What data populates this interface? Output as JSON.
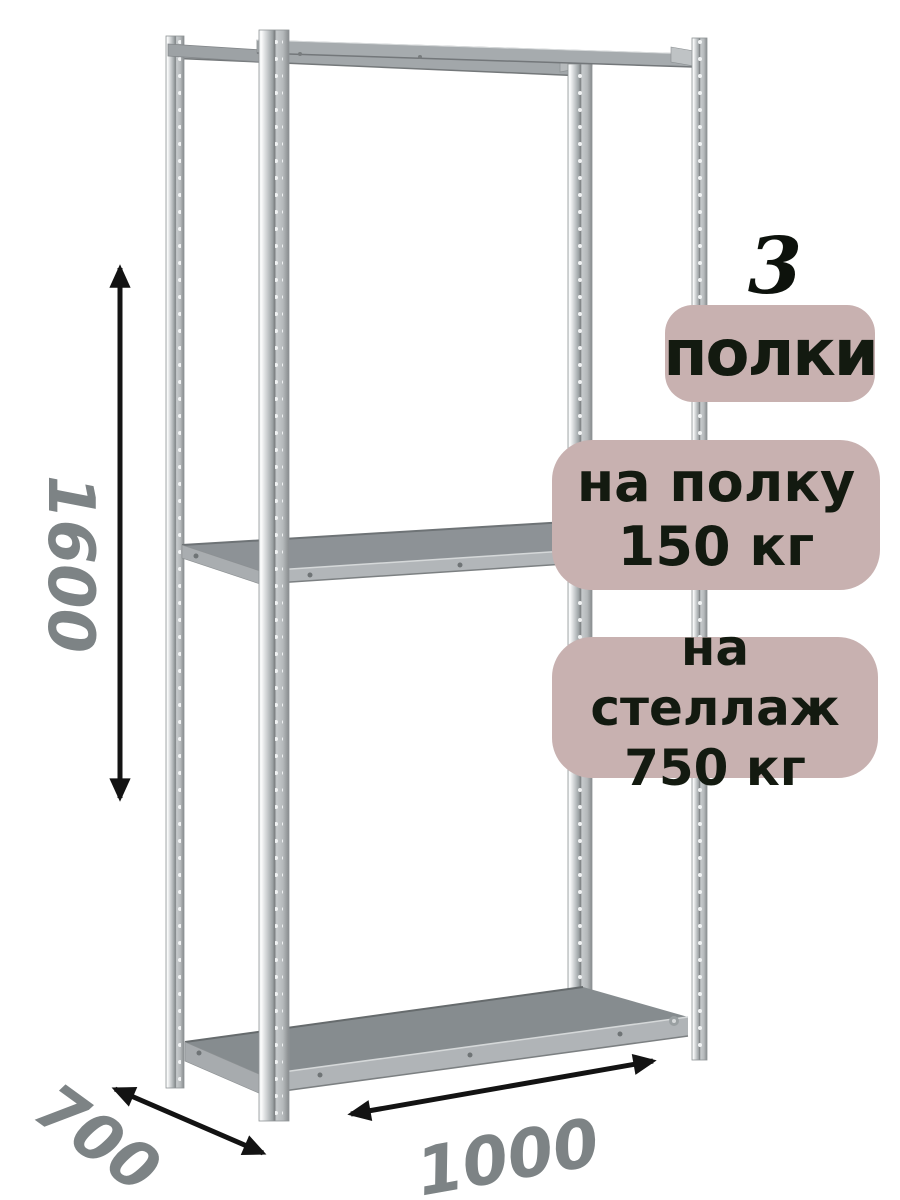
{
  "badges": {
    "count_number": "3",
    "count_label": "полки",
    "shelf_load_line1": "на полку",
    "shelf_load_line2": "150 кг",
    "rack_load_line1": "на стеллаж",
    "rack_load_line2": "750 кг"
  },
  "dimensions": {
    "height": "1600",
    "depth": "700",
    "width": "1000"
  },
  "colors": {
    "badge-bg": "#c8b1b0",
    "badge-text": "#131a10",
    "dim-text": "#7d8385",
    "arrow": "#131313",
    "background": "#ffffff"
  }
}
